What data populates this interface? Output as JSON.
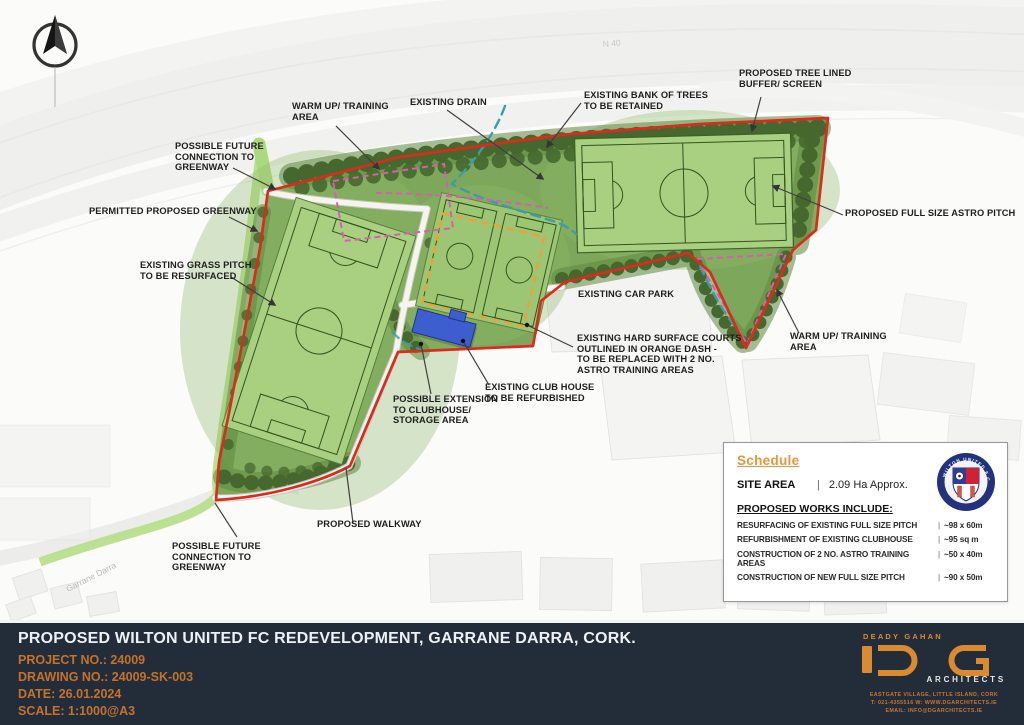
{
  "map": {
    "road_labels": {
      "n40": "N 40",
      "garrane_darra": "Garrane Darra"
    },
    "annotations": [
      {
        "id": "warm-up-area-top",
        "text": "WARM UP/ TRAINING\nAREA"
      },
      {
        "id": "existing-drain",
        "text": "EXISTING DRAIN"
      },
      {
        "id": "bank-of-trees",
        "text": "EXISTING BANK OF TREES\nTO BE RETAINED"
      },
      {
        "id": "tree-lined-buffer",
        "text": "PROPOSED TREE LINED\nBUFFER/ SCREEN"
      },
      {
        "id": "full-size-astro-pitch",
        "text": "PROPOSED FULL SIZE ASTRO PITCH"
      },
      {
        "id": "warm-up-area-right",
        "text": "WARM UP/ TRAINING\nAREA"
      },
      {
        "id": "existing-car-park",
        "text": "EXISTING CAR PARK"
      },
      {
        "id": "hard-surface-courts",
        "text": "EXISTING HARD SURFACE COURTS\nOUTLINED IN ORANGE DASH -\nTO BE REPLACED WITH 2 NO.\nASTRO TRAINING AREAS"
      },
      {
        "id": "existing-club-house",
        "text": "EXISTING CLUB HOUSE\nTO BE REFURBISHED"
      },
      {
        "id": "possible-extension",
        "text": "POSSIBLE EXTENSION\nTO CLUBHOUSE/\nSTORAGE AREA"
      },
      {
        "id": "future-connection-top",
        "text": "POSSIBLE FUTURE\nCONNECTION TO\nGREENWAY"
      },
      {
        "id": "permitted-greenway",
        "text": "PERMITTED PROPOSED GREENWAY"
      },
      {
        "id": "existing-grass-pitch",
        "text": "EXISTING GRASS PITCH\nTO BE RESURFACED"
      },
      {
        "id": "future-connection-bottom",
        "text": "POSSIBLE FUTURE\nCONNECTION TO\nGREENWAY"
      },
      {
        "id": "proposed-walkway",
        "text": "PROPOSED WALKWAY"
      }
    ]
  },
  "schedule": {
    "title": "Schedule",
    "sep": "|",
    "site_area_label": "SITE AREA",
    "site_area_value": "2.09 Ha Approx.",
    "works_heading": "PROPOSED WORKS INCLUDE:",
    "works": [
      {
        "item": "RESURFACING OF EXISTING FULL SIZE PITCH",
        "dim": "~98 x 60m"
      },
      {
        "item": "REFURBISHMENT OF EXISTING CLUBHOUSE",
        "dim": "~95 sq m"
      },
      {
        "item": "CONSTRUCTION OF 2 NO. ASTRO TRAINING AREAS",
        "dim": "~50 x 40m"
      },
      {
        "item": "CONSTRUCTION OF NEW FULL SIZE PITCH",
        "dim": "~90 x 50m"
      }
    ],
    "crest_text": "WILTON UNITED F.C."
  },
  "title_block": {
    "title": "PROPOSED WILTON UNITED FC REDEVELOPMENT, GARRANE DARRA, CORK.",
    "project_no": "PROJECT NO.: 24009",
    "drawing_no": "DRAWING NO.: 24009-SK-003",
    "date": "DATE: 26.01.2024",
    "scale": "SCALE: 1:1000@A3"
  },
  "logo": {
    "firm_top": "DEADY GAHAN",
    "firm_bottom": "ARCHITECTS",
    "address_line1": "EASTGATE VILLAGE, LITTLE ISLAND, CORK",
    "address_line2": "T: 021-4355516   W: WWW.DGARCHITECTS.IE",
    "address_line3": "EMAIL: INFO@DGARCHITECTS.IE"
  },
  "colors": {
    "boundary_red": "#d92b1e",
    "accent_orange": "#e8963c",
    "pitch_green": "#a9cf80",
    "tree_green": "#46682e",
    "drain_teal": "#3b9dac",
    "warmup_pink": "#d75fae",
    "clubhouse_blue": "#3d5ece",
    "titlebar_navy": "#232d39"
  }
}
